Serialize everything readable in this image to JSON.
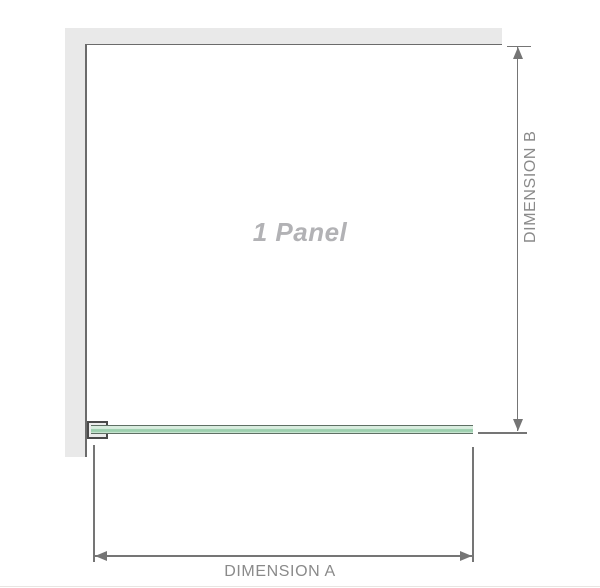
{
  "diagram": {
    "panel_label": "1 Panel",
    "dimension_a_label": "DIMENSION A",
    "dimension_b_label": "DIMENSION B"
  },
  "colors": {
    "wall": "#e9e9e9",
    "edge": "#6b6b6b",
    "dim": "#757575",
    "text": "#8a8a8a",
    "panel-label": "#b2b2b5",
    "glass-edge": "#5f6f64",
    "glass-light": "#d9eddf",
    "glass-mid": "#9ccfae",
    "bracket": "#4a4a4a",
    "bottom-rule": "#e9e5e2"
  }
}
